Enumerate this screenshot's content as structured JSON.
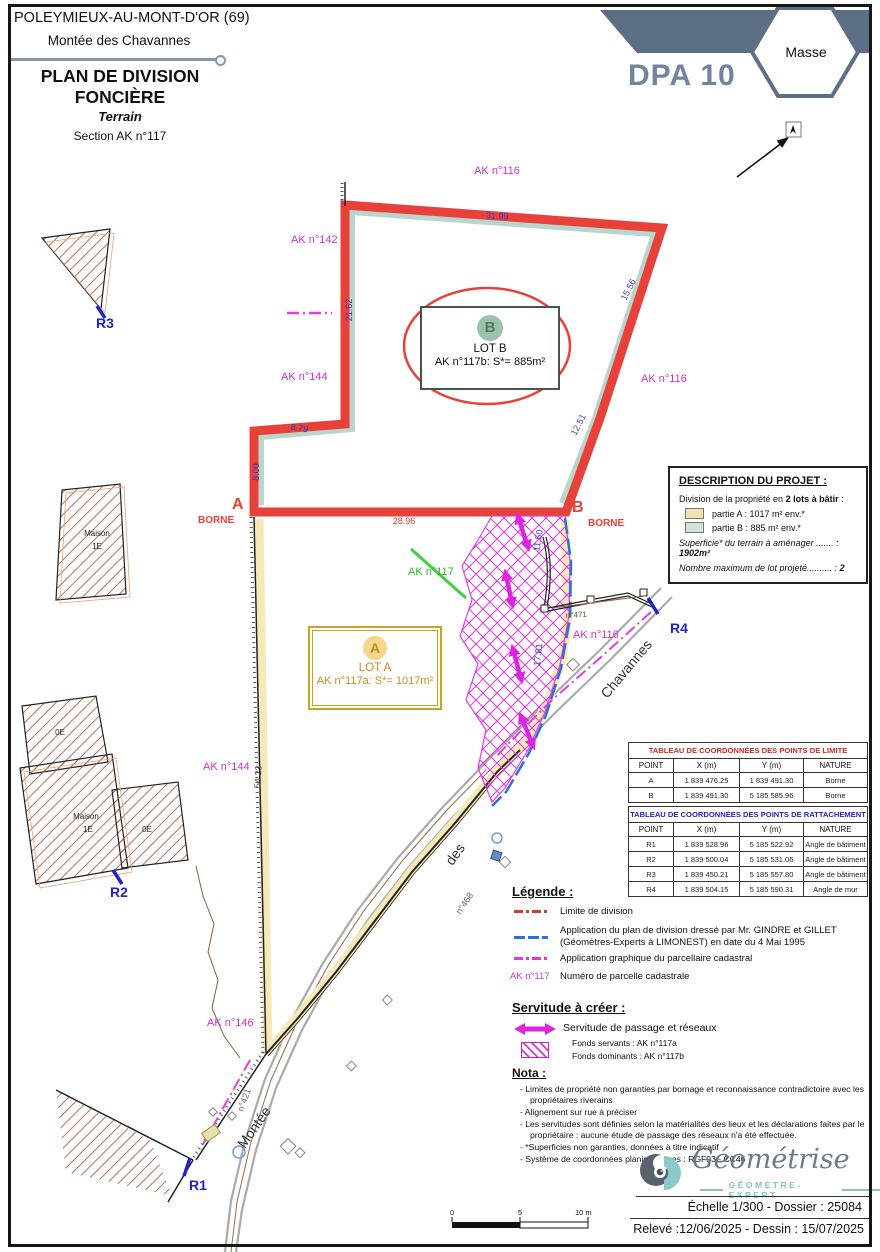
{
  "header": {
    "commune": "POLEYMIEUX-AU-MONT-D'OR (69)",
    "street": "Montée des Chavannes",
    "title_line1": "PLAN DE DIVISION",
    "title_line2": "FONCIÈRE",
    "subtitle": "Terrain",
    "section": "Section AK n°117",
    "doc_ref": "DPA 10",
    "badge": "Masse"
  },
  "lots": {
    "a": {
      "letter": "A",
      "name": "LOT A",
      "area": "AK n°117a: S*= 1017m²"
    },
    "b": {
      "letter": "B",
      "name": "LOT B",
      "area": "AK n°117b: S*= 885m²"
    }
  },
  "map": {
    "parcels": {
      "ak116": "AK n°116",
      "ak142": "AK n°142",
      "ak144": "AK n°144",
      "ak146": "AK n°146",
      "ak117": "AK n°117"
    },
    "dims": {
      "d31_99": "31.99",
      "d15_56": "15.56",
      "d12_51": "12.51",
      "d21_62": "21.62",
      "d8_79": "8.79",
      "d8_00": "8.00",
      "d28_96": "28.96",
      "d11_50": "11.50",
      "d17_81": "17.81",
      "d54_23": "54.23"
    },
    "refs": {
      "n468": "n°468",
      "n421": "n°421",
      "n471": "n°471"
    },
    "points": {
      "a": "A",
      "b": "B",
      "borne": "BORNE",
      "r1": "R1",
      "r2": "R2",
      "r3": "R3",
      "r4": "R4"
    },
    "street": {
      "montee": "Montée",
      "des": "des",
      "chavannes": "Chavannes"
    },
    "buildings": {
      "maison": "Maison",
      "one_e": "1E",
      "zero_e": "0E"
    }
  },
  "description": {
    "title": "DESCRIPTION DU PROJET :",
    "intro_prefix": "Division de la propriété en ",
    "intro_bold": "2 lots à bâtir",
    "intro_suffix": " :",
    "partie_a": "partie A : 1017 m² env.*",
    "partie_b": "partie B : 885 m² env.*",
    "superficie_label": "Superficie* du terrain à aménager ....... : ",
    "superficie_value": "1902m²",
    "nombre_label": "Nombre maximum de lot projeté.......... : ",
    "nombre_value": "2"
  },
  "tables": {
    "limite": {
      "title": "TABLEAU DE COORDONNÉES DES POINTS DE LIMITE",
      "headers": [
        "POINT",
        "X (m)",
        "Y (m)",
        "NATURE"
      ],
      "rows": [
        [
          "A",
          "1 839 476.25",
          "1 839 491.30",
          "Borne"
        ],
        [
          "B",
          "1 839 491.30",
          "5 185 585.96",
          "Borne"
        ]
      ]
    },
    "rattachement": {
      "title": "TABLEAU DE COORDONNÉES DES POINTS DE RATTACHEMENT",
      "headers": [
        "POINT",
        "X (m)",
        "Y (m)",
        "NATURE"
      ],
      "rows": [
        [
          "R1",
          "1 839 528.96",
          "5 185 522.92",
          "Angle de bâtiment"
        ],
        [
          "R2",
          "1 839 500.04",
          "5 185 531.06",
          "Angle de bâtiment"
        ],
        [
          "R3",
          "1 839 450.21",
          "5 185 557.80",
          "Angle de bâtiment"
        ],
        [
          "R4",
          "1 839 504.15",
          "5 185 590.31",
          "Angle de mur"
        ]
      ]
    }
  },
  "legend": {
    "title": "Légende :",
    "item1": "Limite de division",
    "item2_line1": "Application du plan de division dressé par Mr. GINDRE et GILLET",
    "item2_line2": "(Géomètres-Experts à LIMONEST) en date du 4 Mai 1995",
    "item3": "Application graphique du parcellaire cadastral",
    "item4_swatch": "AK n°117",
    "item4": "Numéro de parcelle cadastrale"
  },
  "servitude": {
    "title": "Servitude à créer :",
    "label": "Servitude de passage et réseaux",
    "fonds_servants": "Fonds servants : AK n°117a",
    "fonds_dominants": "Fonds dominants : AK n°117b"
  },
  "nota": {
    "title": "Nota :",
    "items": [
      "Limites de propriété non garanties par bornage et reconnaissance contradictoire avec les propriétaires riverains",
      "Alignement sur rue à préciser",
      "Les servitudes sont définies selon la matérialités des lieux et les déclarations faites par le propriétaire : aucune étude de passage des réseaux n'a été effectuée.",
      "*Superficies non garanties, données à titre indicatif",
      "Système de coordonnées planimétriques : RGF93 - CC46"
    ]
  },
  "scale_bar": {
    "t0": "0",
    "t5": "5",
    "t10": "10 m"
  },
  "footer": {
    "brand": "Géométrise",
    "brand_sub": "GÉOMÈTRE-EXPERT",
    "line1": "Échelle 1/300 - Dossier : 25084",
    "line2": "Relevé :12/06/2025 - Dessin : 15/07/2025"
  },
  "colors": {
    "boundary_red": "#e8413a",
    "parcel_magenta": "#cc33cc",
    "dim_blue": "#3a3acc",
    "plan1995_blue": "#2f6fd6",
    "servitude_magenta": "#e023e0",
    "lot_a_gold": "#c9a227",
    "lot_a_fill": "#f6e9b8",
    "lot_b_teal": "#b9d6cd",
    "banner_slate": "#5b6e84"
  }
}
